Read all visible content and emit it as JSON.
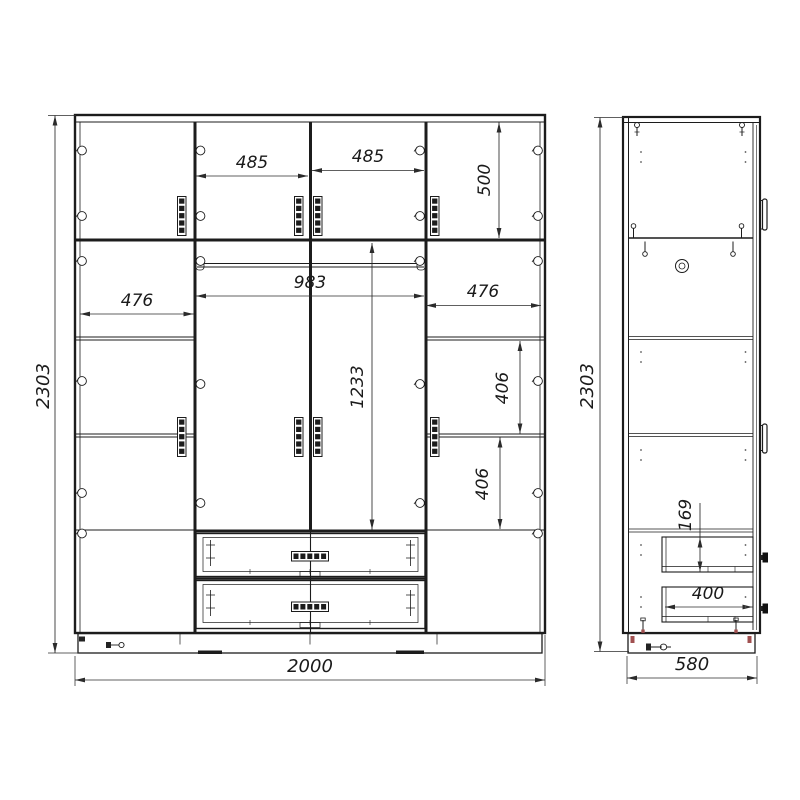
{
  "drawing": {
    "kind": "wardrobe-technical-drawing",
    "line_color": "#1c1c1c",
    "dimension_line_color": "#2b2b2b",
    "background_color": "#ffffff",
    "front_view": {
      "overall_height": "2303",
      "overall_width": "2000",
      "top_door_width_left": "485",
      "top_door_width_right": "485",
      "top_section_height": "500",
      "left_column_width": "476",
      "center_section_width": "983",
      "right_column_width": "476",
      "center_door_height": "1233",
      "right_shelf_gap_upper": "406",
      "right_shelf_gap_lower": "406"
    },
    "side_view": {
      "overall_height": "2303",
      "overall_depth": "580",
      "drawer_front_height": "169",
      "drawer_depth": "400"
    },
    "glyphs": {
      "hinge": "small-circle",
      "door-handle": "vertical-segmented-bar",
      "drawer-handle": "horizontal-segmented-bar",
      "screw": "shaft-with-round-head",
      "cam_lock": "double-circle",
      "drill_hole": "dot"
    }
  }
}
